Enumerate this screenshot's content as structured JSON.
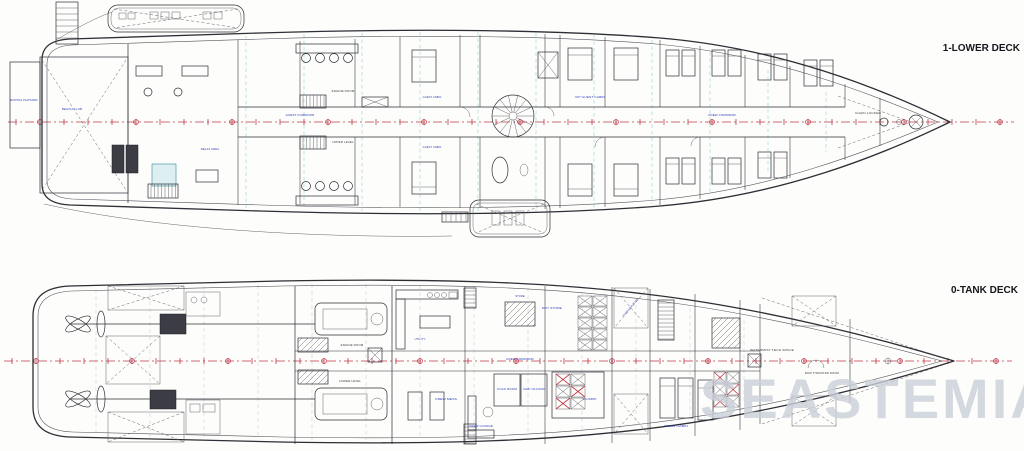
{
  "watermark": {
    "text": "SEASTEMIA",
    "color": "#cbd0d9"
  },
  "colors": {
    "ink": "#2e2e36",
    "label_blue": "#2737b8",
    "centerline_red": "#c03848",
    "frame_cyan": "#8fd6d4"
  },
  "decks": {
    "lower": {
      "title": "1-LOWER DECK",
      "labels": {
        "bathing_platform": "BATHING PLATFORM",
        "beach_club": "BEACH CLUB",
        "relax_area": "RELAX AREA",
        "engine_room": "ENGINE ROOM",
        "upper_level": "UPPER LEVEL",
        "guest_corridor": "GUEST CORRIDOR",
        "guest_cabin": "GUEST CABIN",
        "vip_guest_cabin": "VIP GUEST CABIN",
        "crew_corridor": "CREW CORRIDOR",
        "chain_locker": "CHAIN LOCKER"
      }
    },
    "tank": {
      "title": "0-TANK DECK",
      "labels": {
        "engine_room": "ENGINE ROOM",
        "lower_level": "LOWER LEVEL",
        "utility": "UTILITY",
        "crew_mess": "CREW MESS",
        "crew_lounge": "CREW LOUNGE",
        "store": "STORE",
        "dry_store": "DRY STORE",
        "cold_room": "COLD ROOM",
        "guest_cold_room": "GUEST COLD ROOM",
        "laundry": "LAUNDRY",
        "crew_cabin": "CREW CABIN",
        "crew_corridor": "CREW CORRIDOR",
        "stabilizer": "STABILIZER ROOM",
        "watermist": "WATERMIST TECH SPACE",
        "bow_thruster": "BOW THRUSTER ROOM"
      }
    }
  }
}
